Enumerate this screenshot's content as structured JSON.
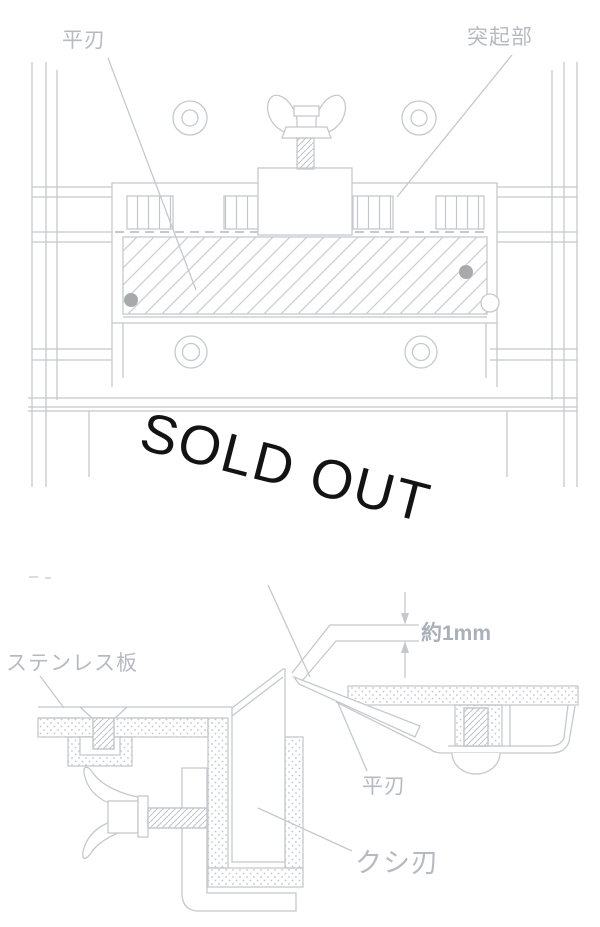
{
  "page": {
    "width": 600,
    "height": 927,
    "background": "#ffffff"
  },
  "palette": {
    "line": "#c5c8ce",
    "hatch": "#caccd1",
    "label_text": "#b6bac2",
    "dimension_text": "#aab0b9",
    "dark_dot": "#a7aaac",
    "sold_out_text": "#131313"
  },
  "top_diagram": {
    "labels": {
      "flat_blade": "平刃",
      "protrusion": "突起部"
    }
  },
  "bottom_diagram": {
    "labels": {
      "stainless_plate": "ステンレス板",
      "dimension": "約1mm",
      "flat_blade": "平刃",
      "comb_blade": "クシ刃"
    }
  },
  "overlay": {
    "sold_out": "SOLD OUT"
  }
}
